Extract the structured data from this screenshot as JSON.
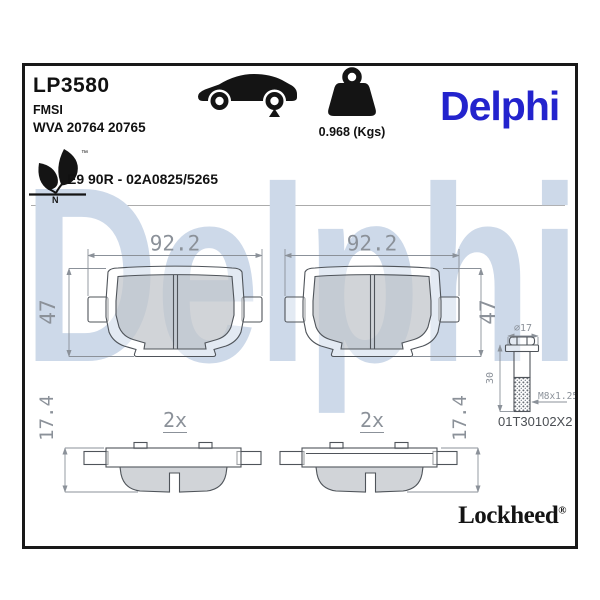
{
  "watermark": "Delphi",
  "header": {
    "part_number": "LP3580",
    "fmsi": "FMSI",
    "wva": "WVA 20764 20765",
    "weight": "0.968 (Kgs)",
    "brand_logo": "Delphi",
    "approval": "E9 90R - 02A0825/5265",
    "eco_letter": "N",
    "eco_trademark": "™",
    "icons": {
      "car": "car-rear-axle-indicator",
      "weight": "weight-block",
      "eco": "eco-leaf-mark"
    }
  },
  "drawing": {
    "pad_width": "92.2",
    "pad_height": "47",
    "pad_thickness": "17.4",
    "quantity": "2x",
    "bolt": {
      "head_diameter": "⌀17",
      "shank_length": "30",
      "thread": "M8x1.25",
      "part_number": "01T30102X2"
    }
  },
  "footer": {
    "brand": "Lockheed",
    "registered_mark": "®"
  },
  "colors": {
    "brand_blue": "#2323cd",
    "watermark_blue": "#cdd9e9",
    "outline": "#4f545a",
    "dimension": "#8b9199"
  }
}
